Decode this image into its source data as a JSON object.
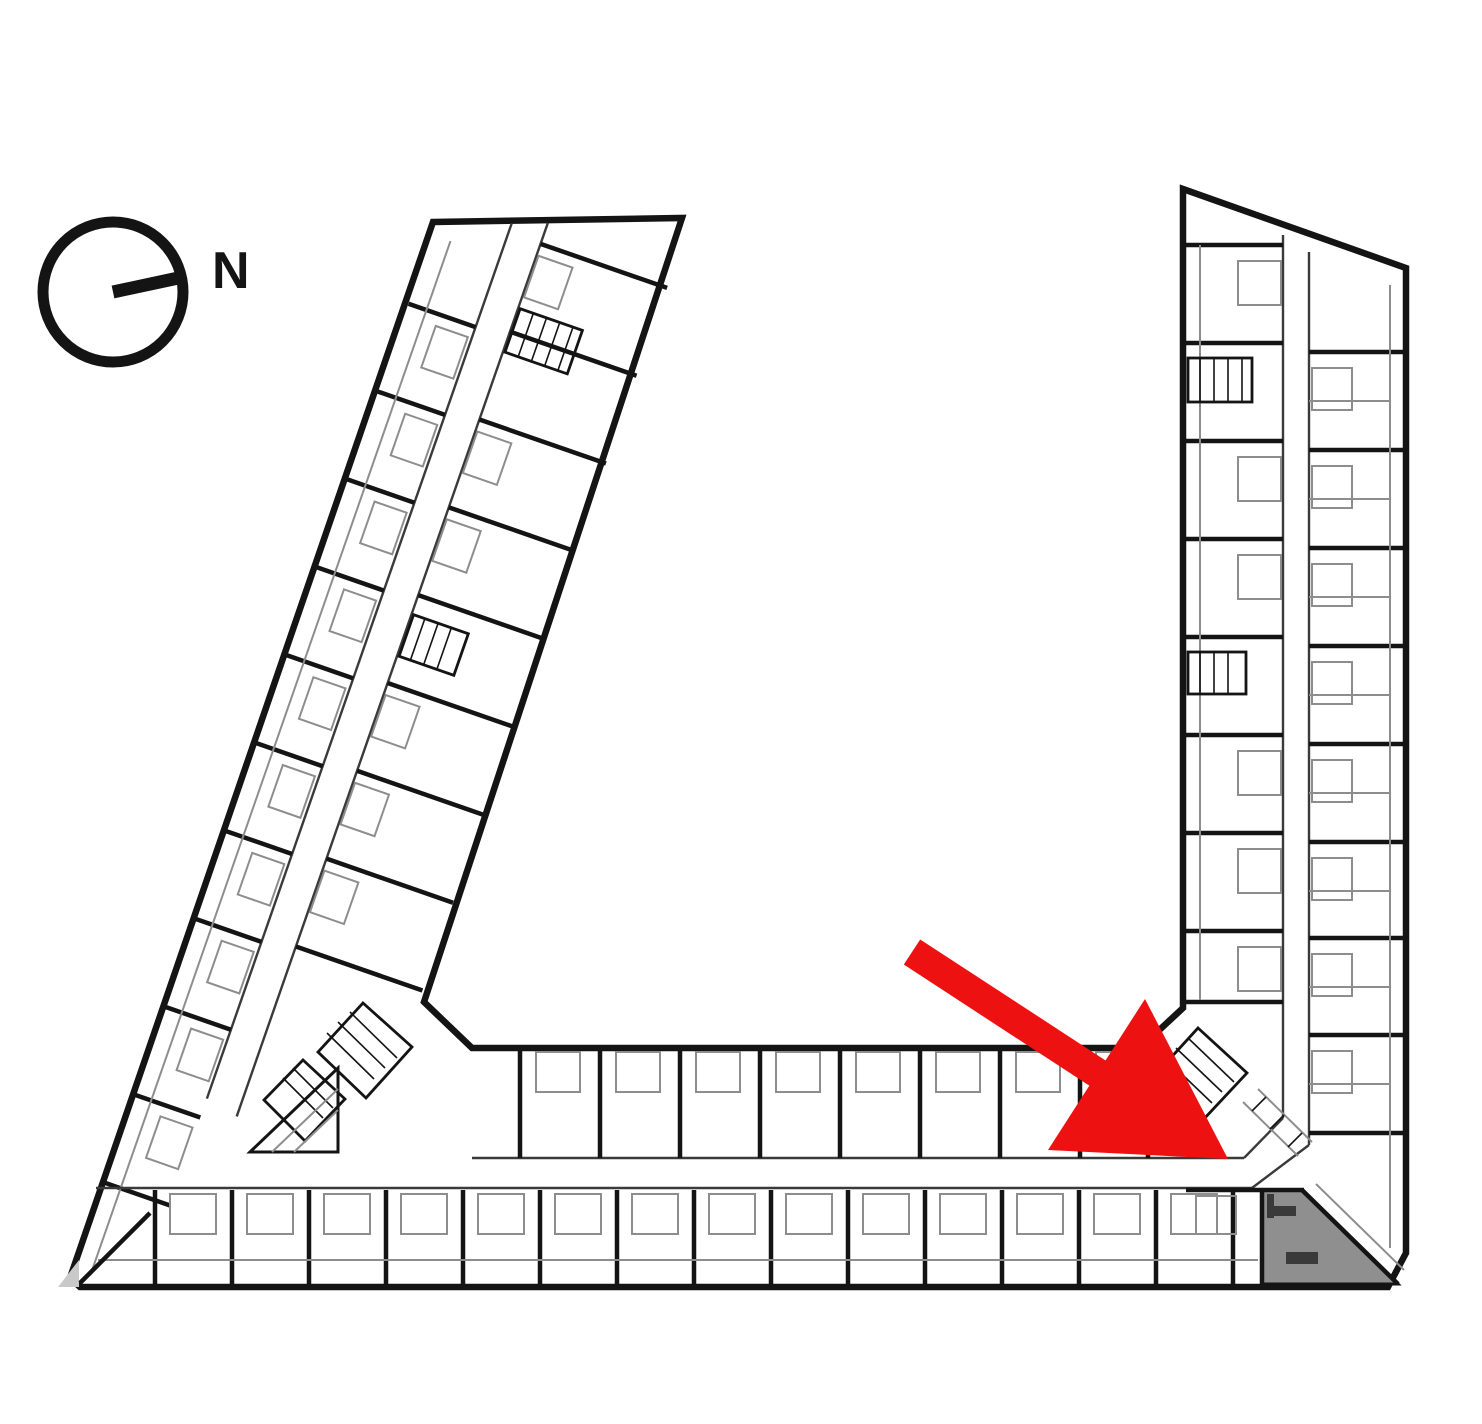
{
  "compass": {
    "label": "N"
  },
  "colors": {
    "wall": "#141414",
    "partition": "#3a3a3a",
    "light": "#8d8d8d",
    "arrow": "#ee1111",
    "highlight": "#8f8f8f",
    "background": "#ffffff",
    "corner_shade": "#c9c9c9"
  },
  "annotations": {
    "arrow": {
      "color": "#ee1111",
      "points_to": "highlighted-unit"
    },
    "highlighted_unit": {
      "fill": "#8f8f8f",
      "location": "bottom-right-corner"
    }
  }
}
